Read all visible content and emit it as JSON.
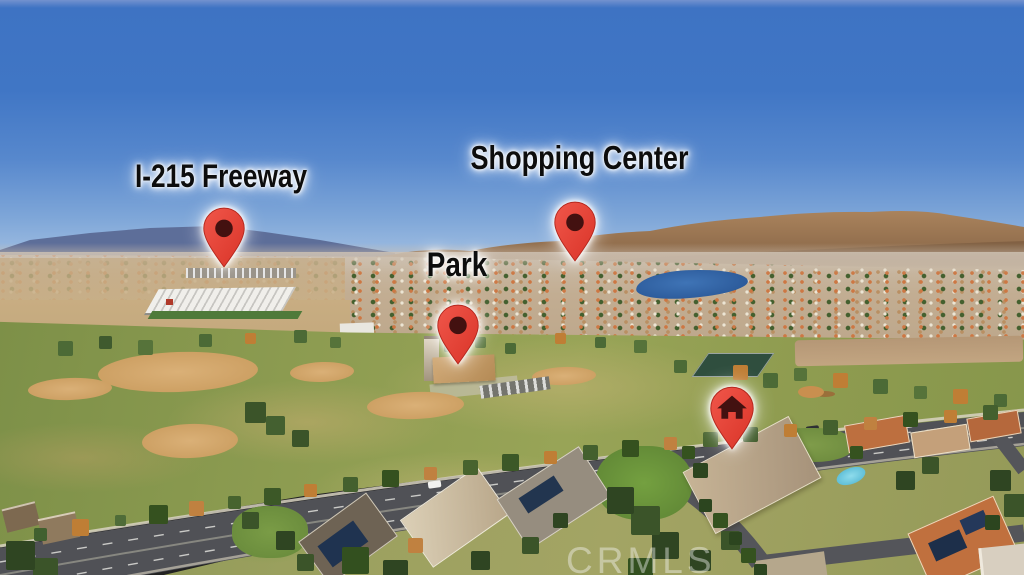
{
  "annotations": {
    "freeway": {
      "label": "I-215 Freeway",
      "icon": "map-pin-dot-icon"
    },
    "shopping_center": {
      "label": "Shopping Center",
      "icon": "map-pin-dot-icon"
    },
    "park": {
      "label": "Park",
      "icon": "map-pin-dot-icon"
    },
    "home": {
      "icon": "map-pin-home-icon"
    }
  },
  "pin_style": {
    "color": "#e64438",
    "color_dark": "#cf3327",
    "dot_color": "#431110",
    "glow": "#ffffff"
  },
  "label_style": {
    "color": "#0d0d0d",
    "glow": "#ffffff"
  },
  "watermark": {
    "text": "CRMLS"
  }
}
